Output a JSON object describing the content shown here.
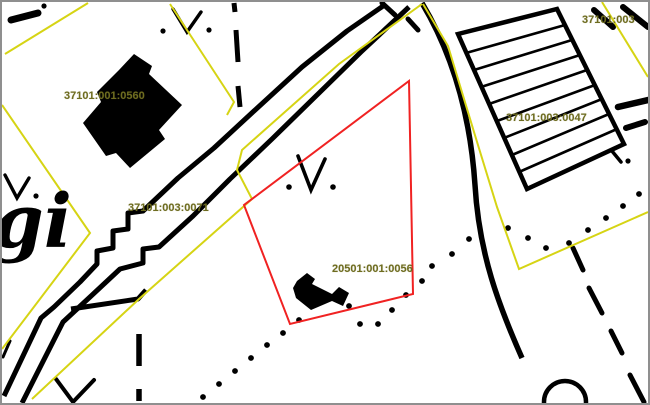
{
  "map": {
    "place_label_fragment": "gi",
    "parcel_labels": [
      "37101:001:0560",
      "37101:003:0071",
      "20501:001:0056",
      "37101:003:0047",
      "37101:003"
    ],
    "selected_parcel": "20501:001:0056",
    "colors": {
      "cadastral_boundary": "#d6d414",
      "selected_parcel_outline": "#f02222",
      "parcel_label_text": "#6e6c20",
      "base_map": "#000000",
      "map_frame": "#8f8f8f",
      "background": "#ffffff"
    }
  }
}
